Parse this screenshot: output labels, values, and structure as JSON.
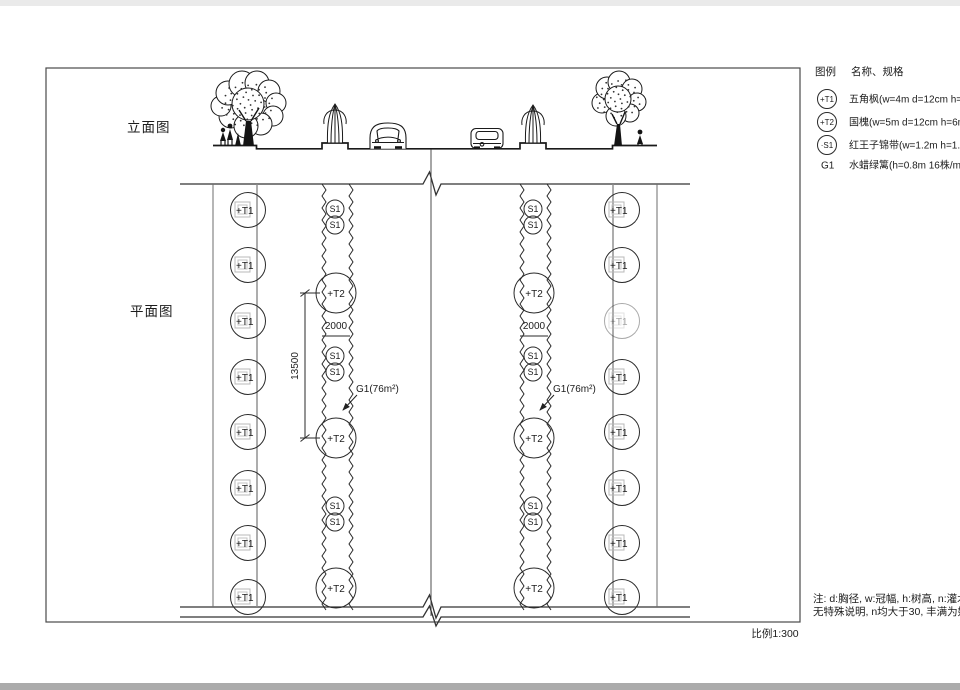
{
  "page": {
    "scale_label": "比例1:300"
  },
  "views": {
    "elevation_title": "立面图",
    "plan_title": "平面图"
  },
  "legend": {
    "title": "图例",
    "spec_header": "名称、规格",
    "items": [
      {
        "symbol": "+T1",
        "name": "五角枫(w=4m d=12cm h=6m)"
      },
      {
        "symbol": "+T2",
        "name": "国槐(w=5m d=12cm h=6m)"
      },
      {
        "symbol": "·S1",
        "name": "红王子锦带(w=1.2m h=1.5m)"
      },
      {
        "symbol": "G1",
        "name": "水蜡绿篱(h=0.8m 16株/m²)"
      }
    ]
  },
  "plan": {
    "t1_label": "+T1",
    "t2_label": "+T2",
    "s1_label": "S1",
    "dim_vertical": "13500",
    "dim_spacing": "2000",
    "g1_area": "G1(76m²)"
  },
  "notes": {
    "line1": "注: d:胸径, w:冠幅, h:树高, n:灌木枝条数",
    "line2": "无特殊说明, n均大于30, 丰满为好"
  },
  "colors": {
    "ink": "#1f1f1f"
  }
}
